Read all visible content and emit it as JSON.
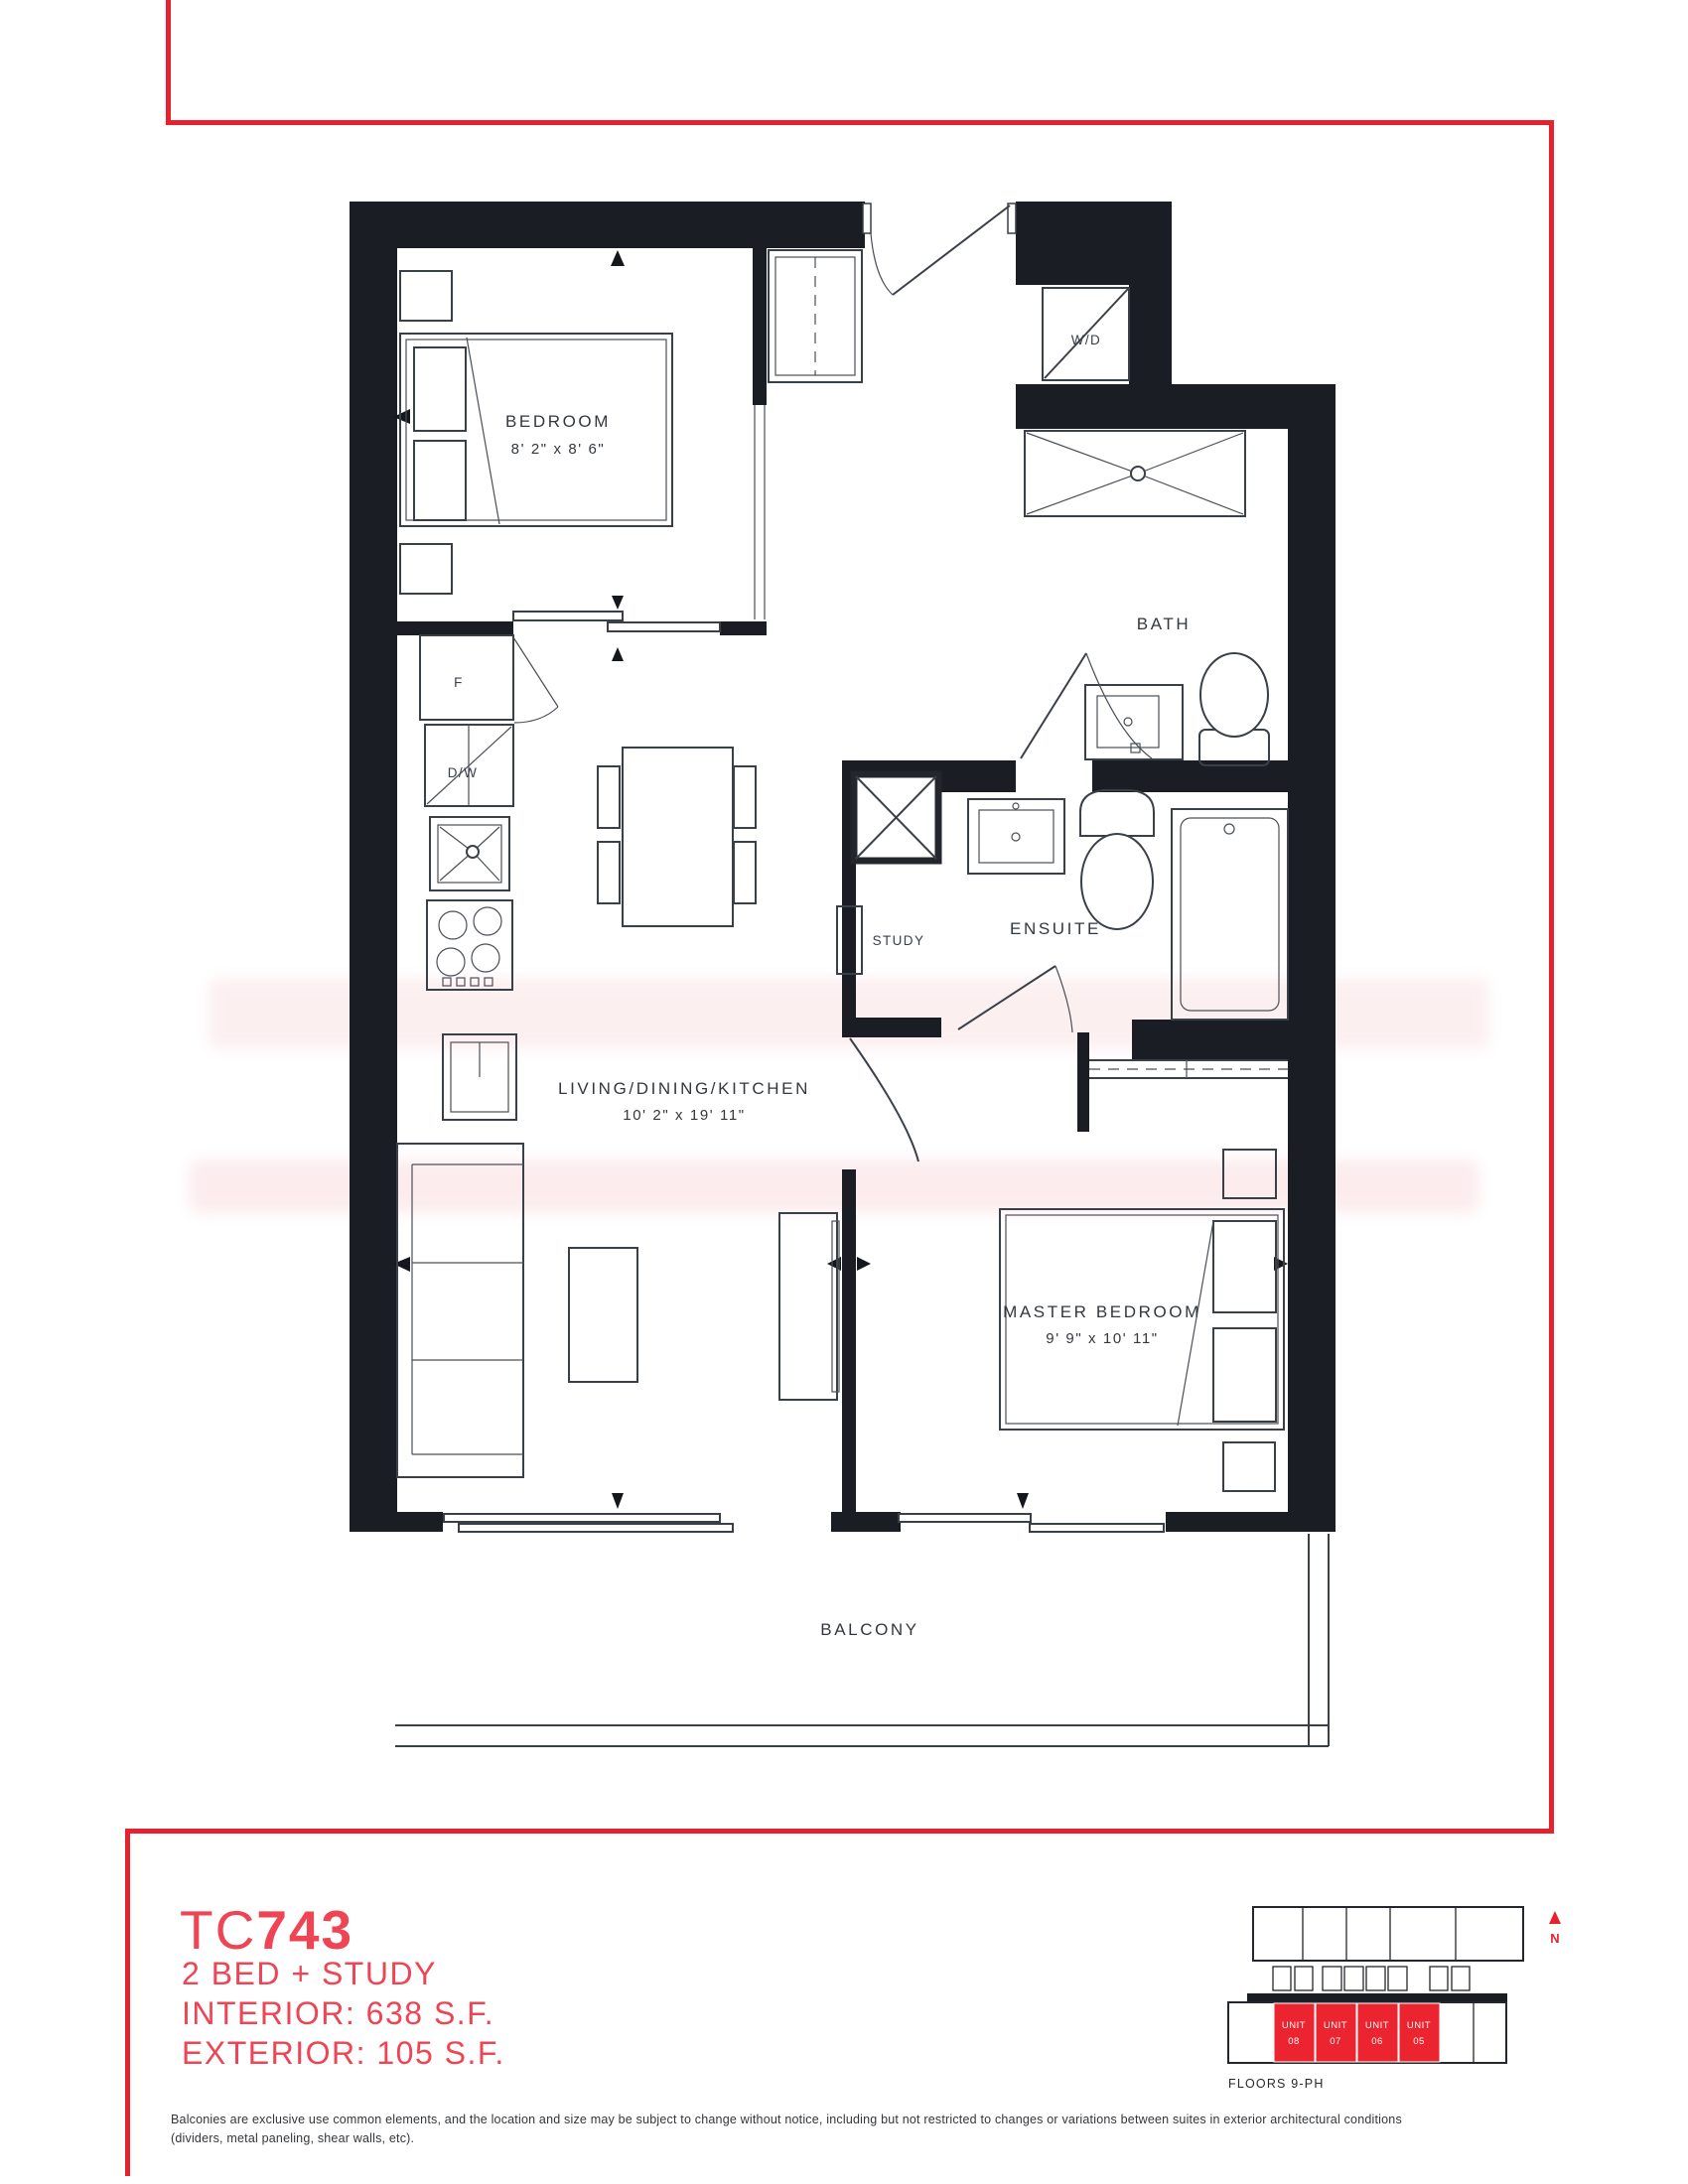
{
  "colors": {
    "accent_red": "#E8212F",
    "title_red": "#EE4453",
    "unit_red": "#EC2430",
    "wall_black": "#1A1E24",
    "line_gray": "#3A4048"
  },
  "plan": {
    "labels": {
      "bedroom": {
        "name": "BEDROOM",
        "dims": "8' 2\" x 8' 6\""
      },
      "living": {
        "name": "LIVING/DINING/KITCHEN",
        "dims": "10' 2\" x 19' 11\""
      },
      "master": {
        "name": "MASTER BEDROOM",
        "dims": "9' 9\" x 10' 11\""
      },
      "bath": "BATH",
      "ensuite": "ENSUITE",
      "study": "STUDY",
      "balcony": "BALCONY",
      "washer_dryer": "W/D",
      "fridge": "F",
      "dishwasher": "D/W"
    }
  },
  "title_block": {
    "model_prefix": "TC",
    "model_number": "743",
    "unit_type": "2 BED + STUDY",
    "interior": "INTERIOR: 638 S.F.",
    "exterior": "EXTERIOR: 105 S.F."
  },
  "key_plan": {
    "units": [
      {
        "label": "UNIT",
        "number": "08"
      },
      {
        "label": "UNIT",
        "number": "07"
      },
      {
        "label": "UNIT",
        "number": "06"
      },
      {
        "label": "UNIT",
        "number": "05"
      }
    ],
    "floors_label": "FLOORS 9-PH",
    "north_label": "N"
  },
  "disclaimer": {
    "line1": "Balconies are exclusive use common elements, and the location and size may be subject to change without notice, including but not restricted to changes or variations between suites in exterior architectural conditions",
    "line2": "(dividers, metal paneling, shear walls, etc)."
  }
}
